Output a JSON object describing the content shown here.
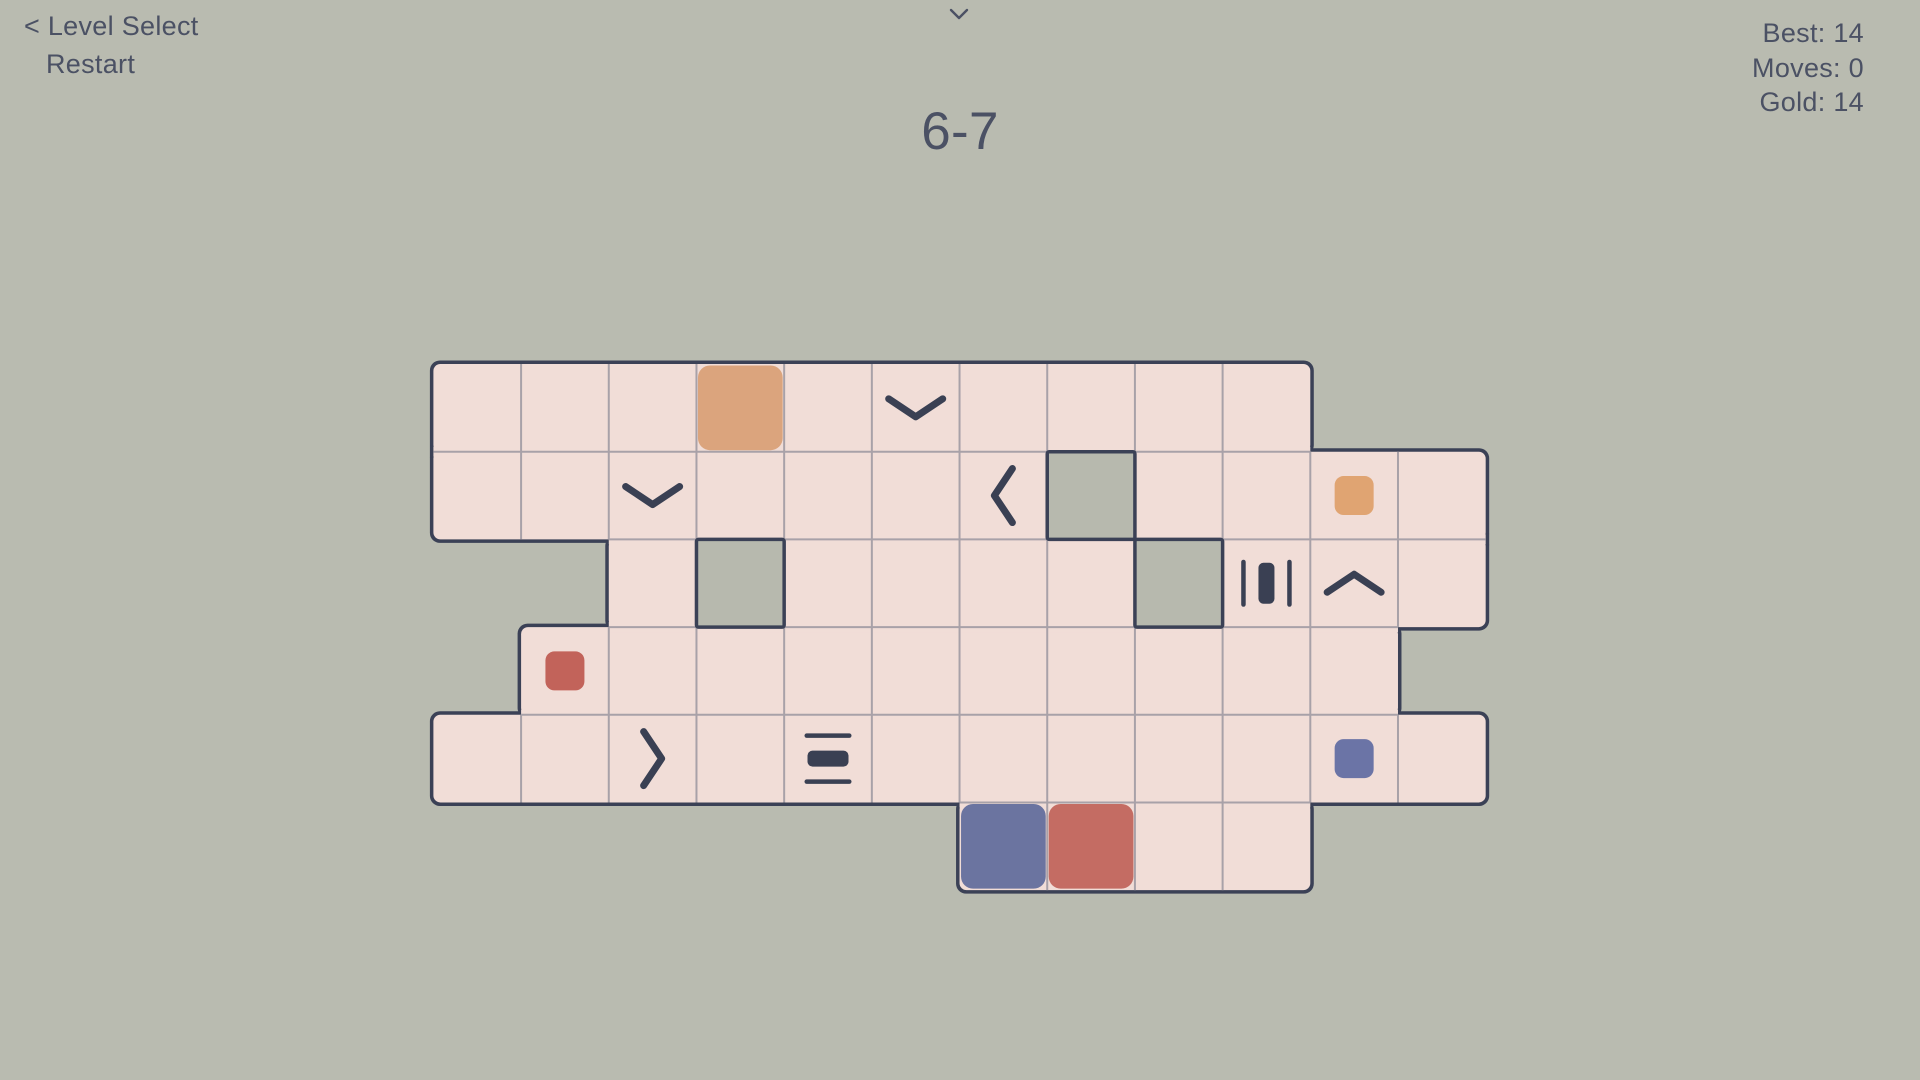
{
  "header": {
    "level_select_label": "< Level Select",
    "restart_label": "Restart",
    "title": "6-7",
    "collapse_icon": "chevron-down",
    "stats": [
      {
        "id": "best",
        "label": "Best:",
        "value": "14"
      },
      {
        "id": "moves",
        "label": "Moves:",
        "value": "0"
      },
      {
        "id": "gold",
        "label": "Gold:",
        "value": "14"
      }
    ]
  },
  "board": {
    "rows": 6,
    "columns": 12,
    "row_spans": [
      {
        "row": 1,
        "from": 1,
        "to": 10
      },
      {
        "row": 2,
        "from": 1,
        "to": 12
      },
      {
        "row": 3,
        "from": 3,
        "to": 12
      },
      {
        "row": 4,
        "from": 2,
        "to": 11
      },
      {
        "row": 5,
        "from": 1,
        "to": 12
      },
      {
        "row": 6,
        "from": 7,
        "to": 10
      }
    ],
    "holes": [
      {
        "row": 2,
        "col": 8
      },
      {
        "row": 3,
        "col": 4
      },
      {
        "row": 3,
        "col": 9
      }
    ],
    "icons": [
      {
        "row": 1,
        "col": 6,
        "type": "chevron-down"
      },
      {
        "row": 2,
        "col": 3,
        "type": "chevron-down"
      },
      {
        "row": 2,
        "col": 7,
        "type": "chevron-left"
      },
      {
        "row": 3,
        "col": 10,
        "type": "bars-vertical"
      },
      {
        "row": 3,
        "col": 11,
        "type": "chevron-up"
      },
      {
        "row": 5,
        "col": 3,
        "type": "chevron-right"
      },
      {
        "row": 5,
        "col": 5,
        "type": "bars-horizontal"
      }
    ],
    "blocks": [
      {
        "row": 1,
        "col": 4,
        "color": "orange",
        "size": "large"
      },
      {
        "row": 2,
        "col": 11,
        "color": "orange",
        "size": "small"
      },
      {
        "row": 4,
        "col": 2,
        "color": "red",
        "size": "small"
      },
      {
        "row": 5,
        "col": 11,
        "color": "blue",
        "size": "small"
      },
      {
        "row": 6,
        "col": 7,
        "color": "blue",
        "size": "large"
      },
      {
        "row": 6,
        "col": 8,
        "color": "red",
        "size": "large"
      }
    ],
    "colors": {
      "background": "#b9bbb0",
      "tile": "#f1ddd7",
      "grid_line": "#a8a1a8",
      "outline": "#3b4156",
      "icon": "#3a4053",
      "hole": "#b7b9ae",
      "orange_large": "#dba47d",
      "orange_small": "#e0a472",
      "red_large": "#c46c63",
      "red_small": "#c2635a",
      "blue_large": "#6b74a0",
      "blue_small": "#6b74a6",
      "text": "#4b5164"
    }
  }
}
